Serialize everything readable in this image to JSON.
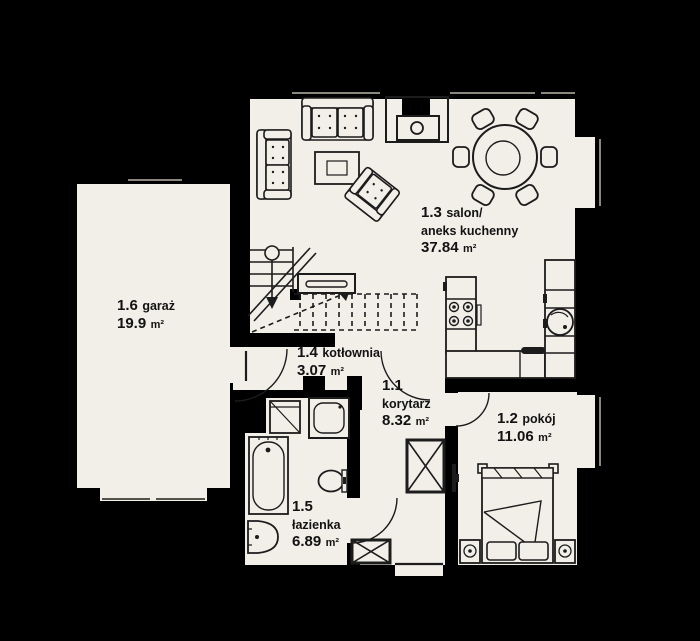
{
  "plan": {
    "colors": {
      "background": "#000000",
      "floor": "#f2efe9",
      "line": "#1c1c1c",
      "window": "#8a877f"
    },
    "rooms": {
      "korytarz": {
        "number": "1.1",
        "name": "korytarz",
        "area": "8.32",
        "unit": "m²"
      },
      "pokoj": {
        "number": "1.2",
        "name": "pokój",
        "area": "11.06",
        "unit": "m²"
      },
      "salon": {
        "number": "1.3",
        "name": "salon/",
        "name2": "aneks kuchenny",
        "area": "37.84",
        "unit": "m²"
      },
      "kotlownia": {
        "number": "1.4",
        "name": "kotłownia",
        "area": "3.07",
        "unit": "m²"
      },
      "lazienka": {
        "number": "1.5",
        "name": "łazienka",
        "area": "6.89",
        "unit": "m²"
      },
      "garaz": {
        "number": "1.6",
        "name": "garaż",
        "area": "19.9",
        "unit": "m²"
      }
    }
  }
}
